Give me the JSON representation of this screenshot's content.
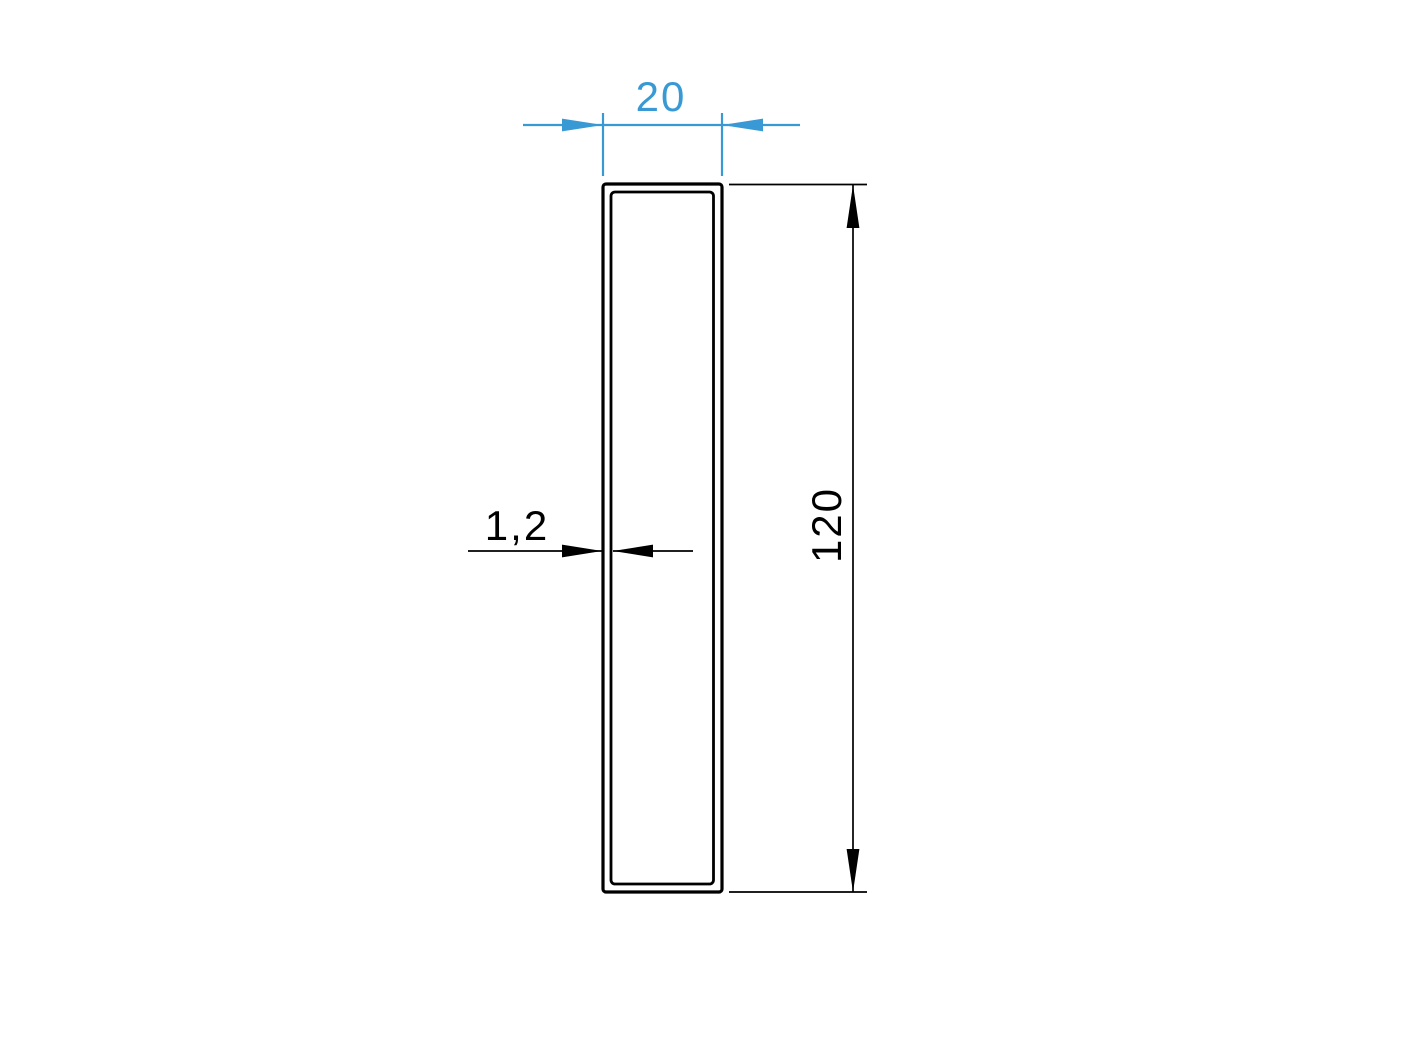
{
  "colors": {
    "accent_blue": "#3899D5",
    "line_black": "#000000",
    "background": "#ffffff"
  },
  "drawing": {
    "dimensions": {
      "width": "20",
      "height": "120",
      "wall_thickness": "1,2"
    }
  }
}
